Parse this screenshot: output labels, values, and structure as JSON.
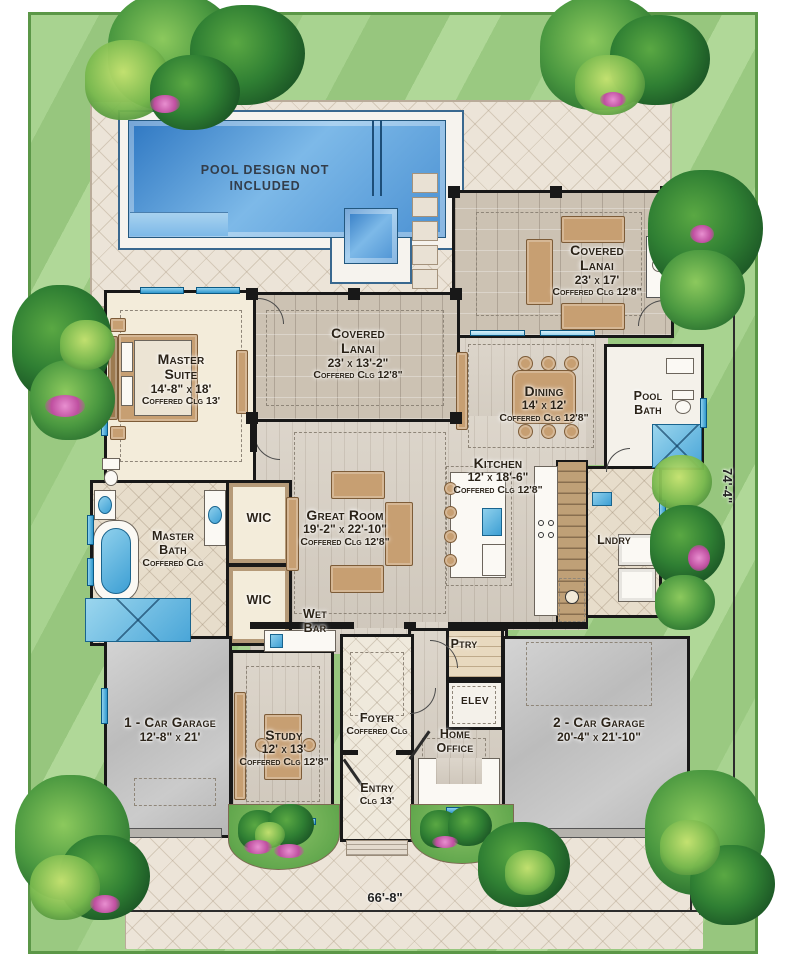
{
  "pool_area": {
    "note": "Pool Design Not Included"
  },
  "rooms": {
    "covered_lanai_upper": {
      "name": "Covered Lanai",
      "dims": "23' x 17'",
      "ceiling": "Coffered Clg 12'8\""
    },
    "covered_lanai_lower": {
      "name": "Covered Lanai",
      "dims": "23' x 13'-2\"",
      "ceiling": "Coffered Clg 12'8\""
    },
    "master_suite": {
      "name": "Master Suite",
      "dims": "14'-8\" x 18'",
      "ceiling": "Coffered Clg 13'"
    },
    "dining": {
      "name": "Dining",
      "dims": "14' x 12'",
      "ceiling": "Coffered Clg 12'8\""
    },
    "pool_bath": {
      "name": "Pool Bath"
    },
    "kitchen": {
      "name": "Kitchen",
      "dims": "12' x 18'-6\"",
      "ceiling": "Coffered Clg 12'8\""
    },
    "great_room": {
      "name": "Great Room",
      "dims": "19'-2\" x 22'-10\"",
      "ceiling": "Coffered Clg 12'8\""
    },
    "master_bath": {
      "name": "Master Bath",
      "ceiling": "Coffered Clg"
    },
    "wic_upper": {
      "name": "WIC"
    },
    "wic_lower": {
      "name": "WIC"
    },
    "laundry": {
      "name": "Lndry"
    },
    "wet_bar": {
      "name": "Wet Bar"
    },
    "pantry": {
      "name": "Ptry"
    },
    "elevator": {
      "name": "ELEV"
    },
    "garage_1": {
      "name": "1 - Car Garage",
      "dims": "12'-8\" x 21'"
    },
    "study": {
      "name": "Study",
      "dims": "12' x 13'",
      "ceiling": "Coffered Clg 12'8\""
    },
    "foyer": {
      "name": "Foyer",
      "ceiling": "Coffered Clg"
    },
    "entry": {
      "name": "Entry",
      "ceiling": "Clg 13'"
    },
    "home_office": {
      "name": "Home Office"
    },
    "garage_2": {
      "name": "2 - Car Garage",
      "dims": "20'-4\" x 21'-10\""
    }
  },
  "dimensions": {
    "overall_width": "66'-8\"",
    "overall_depth": "74'-4\""
  },
  "colors": {
    "lawn": "#9cca84",
    "pool_water": "#4a90d2",
    "deck": "#ece4d8",
    "wall": "#181818",
    "window": "#2f97cc",
    "accent_flower": "#bf4fa0"
  }
}
